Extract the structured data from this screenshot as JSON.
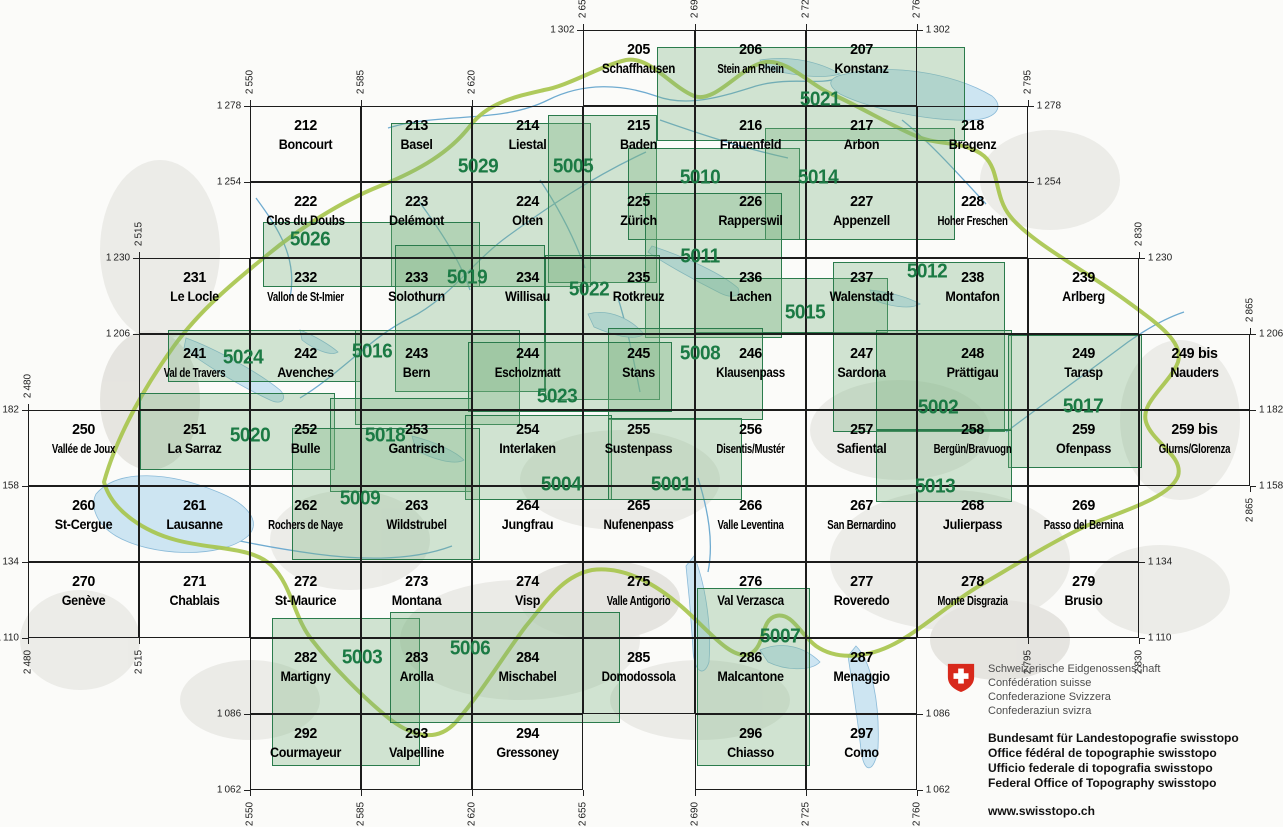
{
  "map": {
    "description": "Index of Swiss national map sheets with composite sheet numbers",
    "colors": {
      "grid_line": "#1c1c1c",
      "composite_fill": "rgba(122,178,128,0.33)",
      "composite_border": "#2a7b4c",
      "composite_label": "#1b7a44",
      "country_border": "#a6c44a",
      "lake": "#cde5f2",
      "river": "#6fabd0",
      "swiss_red": "#d8291c"
    },
    "sheets": [
      {
        "number": "205",
        "name": "Schaffhausen",
        "x_km": 2655,
        "y_km": 1302
      },
      {
        "number": "206",
        "name": "Stein am Rhein",
        "x_km": 2690,
        "y_km": 1302
      },
      {
        "number": "207",
        "name": "Konstanz",
        "x_km": 2725,
        "y_km": 1302
      },
      {
        "number": "212",
        "name": "Boncourt",
        "x_km": 2550,
        "y_km": 1278
      },
      {
        "number": "213",
        "name": "Basel",
        "x_km": 2585,
        "y_km": 1278
      },
      {
        "number": "214",
        "name": "Liestal",
        "x_km": 2620,
        "y_km": 1278
      },
      {
        "number": "215",
        "name": "Baden",
        "x_km": 2655,
        "y_km": 1278
      },
      {
        "number": "216",
        "name": "Frauenfeld",
        "x_km": 2690,
        "y_km": 1278
      },
      {
        "number": "217",
        "name": "Arbon",
        "x_km": 2725,
        "y_km": 1278
      },
      {
        "number": "218",
        "name": "Bregenz",
        "x_km": 2760,
        "y_km": 1278
      },
      {
        "number": "222",
        "name": "Clos du Doubs",
        "x_km": 2550,
        "y_km": 1254
      },
      {
        "number": "223",
        "name": "Delémont",
        "x_km": 2585,
        "y_km": 1254
      },
      {
        "number": "224",
        "name": "Olten",
        "x_km": 2620,
        "y_km": 1254
      },
      {
        "number": "225",
        "name": "Zürich",
        "x_km": 2655,
        "y_km": 1254
      },
      {
        "number": "226",
        "name": "Rapperswil",
        "x_km": 2690,
        "y_km": 1254
      },
      {
        "number": "227",
        "name": "Appenzell",
        "x_km": 2725,
        "y_km": 1254
      },
      {
        "number": "228",
        "name": "Hoher Freschen",
        "x_km": 2760,
        "y_km": 1254
      },
      {
        "number": "231",
        "name": "Le Locle",
        "x_km": 2515,
        "y_km": 1230
      },
      {
        "number": "232",
        "name": "Vallon de St-Imier",
        "x_km": 2550,
        "y_km": 1230
      },
      {
        "number": "233",
        "name": "Solothurn",
        "x_km": 2585,
        "y_km": 1230
      },
      {
        "number": "234",
        "name": "Willisau",
        "x_km": 2620,
        "y_km": 1230
      },
      {
        "number": "235",
        "name": "Rotkreuz",
        "x_km": 2655,
        "y_km": 1230
      },
      {
        "number": "236",
        "name": "Lachen",
        "x_km": 2690,
        "y_km": 1230
      },
      {
        "number": "237",
        "name": "Walenstadt",
        "x_km": 2725,
        "y_km": 1230
      },
      {
        "number": "238",
        "name": "Montafon",
        "x_km": 2760,
        "y_km": 1230
      },
      {
        "number": "239",
        "name": "Arlberg",
        "x_km": 2795,
        "y_km": 1230
      },
      {
        "number": "241",
        "name": "Val de Travers",
        "x_km": 2515,
        "y_km": 1206
      },
      {
        "number": "242",
        "name": "Avenches",
        "x_km": 2550,
        "y_km": 1206
      },
      {
        "number": "243",
        "name": "Bern",
        "x_km": 2585,
        "y_km": 1206
      },
      {
        "number": "244",
        "name": "Escholzmatt",
        "x_km": 2620,
        "y_km": 1206
      },
      {
        "number": "245",
        "name": "Stans",
        "x_km": 2655,
        "y_km": 1206
      },
      {
        "number": "246",
        "name": "Klausenpass",
        "x_km": 2690,
        "y_km": 1206
      },
      {
        "number": "247",
        "name": "Sardona",
        "x_km": 2725,
        "y_km": 1206
      },
      {
        "number": "248",
        "name": "Prättigau",
        "x_km": 2760,
        "y_km": 1206
      },
      {
        "number": "249",
        "name": "Tarasp",
        "x_km": 2795,
        "y_km": 1206
      },
      {
        "number": "249 bis",
        "name": "Nauders",
        "x_km": 2830,
        "y_km": 1206
      },
      {
        "number": "250",
        "name": "Vallée de Joux",
        "x_km": 2480,
        "y_km": 1182
      },
      {
        "number": "251",
        "name": "La Sarraz",
        "x_km": 2515,
        "y_km": 1182
      },
      {
        "number": "252",
        "name": "Bulle",
        "x_km": 2550,
        "y_km": 1182
      },
      {
        "number": "253",
        "name": "Gantrisch",
        "x_km": 2585,
        "y_km": 1182
      },
      {
        "number": "254",
        "name": "Interlaken",
        "x_km": 2620,
        "y_km": 1182
      },
      {
        "number": "255",
        "name": "Sustenpass",
        "x_km": 2655,
        "y_km": 1182
      },
      {
        "number": "256",
        "name": "Disentis/Mustér",
        "x_km": 2690,
        "y_km": 1182
      },
      {
        "number": "257",
        "name": "Safiental",
        "x_km": 2725,
        "y_km": 1182
      },
      {
        "number": "258",
        "name": "Bergün/Bravuogn",
        "x_km": 2760,
        "y_km": 1182
      },
      {
        "number": "259",
        "name": "Ofenpass",
        "x_km": 2795,
        "y_km": 1182
      },
      {
        "number": "259 bis",
        "name": "Glurns/Glorenza",
        "x_km": 2830,
        "y_km": 1182
      },
      {
        "number": "260",
        "name": "St-Cergue",
        "x_km": 2480,
        "y_km": 1158
      },
      {
        "number": "261",
        "name": "Lausanne",
        "x_km": 2515,
        "y_km": 1158
      },
      {
        "number": "262",
        "name": "Rochers de Naye",
        "x_km": 2550,
        "y_km": 1158
      },
      {
        "number": "263",
        "name": "Wildstrubel",
        "x_km": 2585,
        "y_km": 1158
      },
      {
        "number": "264",
        "name": "Jungfrau",
        "x_km": 2620,
        "y_km": 1158
      },
      {
        "number": "265",
        "name": "Nufenenpass",
        "x_km": 2655,
        "y_km": 1158
      },
      {
        "number": "266",
        "name": "Valle Leventina",
        "x_km": 2690,
        "y_km": 1158
      },
      {
        "number": "267",
        "name": "San Bernardino",
        "x_km": 2725,
        "y_km": 1158
      },
      {
        "number": "268",
        "name": "Julierpass",
        "x_km": 2760,
        "y_km": 1158
      },
      {
        "number": "269",
        "name": "Passo del Bernina",
        "x_km": 2795,
        "y_km": 1158
      },
      {
        "number": "270",
        "name": "Genève",
        "x_km": 2480,
        "y_km": 1134
      },
      {
        "number": "271",
        "name": "Chablais",
        "x_km": 2515,
        "y_km": 1134
      },
      {
        "number": "272",
        "name": "St-Maurice",
        "x_km": 2550,
        "y_km": 1134
      },
      {
        "number": "273",
        "name": "Montana",
        "x_km": 2585,
        "y_km": 1134
      },
      {
        "number": "274",
        "name": "Visp",
        "x_km": 2620,
        "y_km": 1134
      },
      {
        "number": "275",
        "name": "Valle Antigorio",
        "x_km": 2655,
        "y_km": 1134
      },
      {
        "number": "276",
        "name": "Val Verzasca",
        "x_km": 2690,
        "y_km": 1134
      },
      {
        "number": "277",
        "name": "Roveredo",
        "x_km": 2725,
        "y_km": 1134
      },
      {
        "number": "278",
        "name": "Monte Disgrazia",
        "x_km": 2760,
        "y_km": 1134
      },
      {
        "number": "279",
        "name": "Brusio",
        "x_km": 2795,
        "y_km": 1134
      },
      {
        "number": "282",
        "name": "Martigny",
        "x_km": 2550,
        "y_km": 1110
      },
      {
        "number": "283",
        "name": "Arolla",
        "x_km": 2585,
        "y_km": 1110
      },
      {
        "number": "284",
        "name": "Mischabel",
        "x_km": 2620,
        "y_km": 1110
      },
      {
        "number": "285",
        "name": "Domodossola",
        "x_km": 2655,
        "y_km": 1110
      },
      {
        "number": "286",
        "name": "Malcantone",
        "x_km": 2690,
        "y_km": 1110
      },
      {
        "number": "287",
        "name": "Menaggio",
        "x_km": 2725,
        "y_km": 1110
      },
      {
        "number": "292",
        "name": "Courmayeur",
        "x_km": 2550,
        "y_km": 1086
      },
      {
        "number": "293",
        "name": "Valpelline",
        "x_km": 2585,
        "y_km": 1086
      },
      {
        "number": "294",
        "name": "Gressoney",
        "x_km": 2620,
        "y_km": 1086
      },
      {
        "number": "296",
        "name": "Chiasso",
        "x_km": 2690,
        "y_km": 1086
      },
      {
        "number": "297",
        "name": "Como",
        "x_km": 2725,
        "y_km": 1086
      }
    ],
    "composites": [
      {
        "code": "5029",
        "rect": [
          391,
          123,
          200,
          164
        ],
        "label": [
          478,
          167
        ]
      },
      {
        "code": "5005",
        "rect": [
          548,
          115,
          109,
          168
        ],
        "label": [
          573,
          167
        ]
      },
      {
        "code": "5010",
        "rect": [
          628,
          148,
          172,
          92
        ],
        "label": [
          700,
          178
        ]
      },
      {
        "code": "5014",
        "rect": [
          765,
          128,
          190,
          112
        ],
        "label": [
          818,
          178
        ]
      },
      {
        "code": "5021",
        "rect": [
          657,
          47,
          308,
          94
        ],
        "label": [
          820,
          100
        ]
      },
      {
        "code": "5026",
        "rect": [
          263,
          222,
          217,
          65
        ],
        "label": [
          310,
          240
        ]
      },
      {
        "code": "5011",
        "rect": [
          645,
          193,
          137,
          145
        ],
        "label": [
          700,
          257
        ]
      },
      {
        "code": "5019",
        "rect": [
          395,
          245,
          150,
          147
        ],
        "label": [
          467,
          278
        ]
      },
      {
        "code": "5022",
        "rect": [
          545,
          255,
          115,
          145
        ],
        "label": [
          589,
          290
        ]
      },
      {
        "code": "5015",
        "rect": [
          695,
          278,
          193,
          55
        ],
        "label": [
          805,
          313
        ]
      },
      {
        "code": "5012",
        "rect": [
          833,
          262,
          172,
          170
        ],
        "label": [
          927,
          272
        ]
      },
      {
        "code": "5024",
        "rect": [
          168,
          330,
          194,
          52
        ],
        "label": [
          243,
          358
        ]
      },
      {
        "code": "5016",
        "rect": [
          355,
          330,
          165,
          95
        ],
        "label": [
          372,
          352
        ]
      },
      {
        "code": "5008",
        "rect": [
          608,
          328,
          155,
          92
        ],
        "label": [
          700,
          354
        ]
      },
      {
        "code": "5023",
        "rect": [
          468,
          342,
          204,
          70
        ],
        "label": [
          557,
          397
        ]
      },
      {
        "code": "5002",
        "rect": [
          876,
          330,
          136,
          100
        ],
        "label": [
          938,
          408
        ]
      },
      {
        "code": "5017",
        "rect": [
          1008,
          335,
          134,
          133
        ],
        "label": [
          1083,
          407
        ]
      },
      {
        "code": "5020",
        "rect": [
          140,
          393,
          195,
          77
        ],
        "label": [
          250,
          436
        ]
      },
      {
        "code": "5018",
        "rect": [
          330,
          398,
          142,
          94
        ],
        "label": [
          385,
          436
        ]
      },
      {
        "code": "5004",
        "rect": [
          465,
          415,
          147,
          85
        ],
        "label": [
          561,
          485
        ]
      },
      {
        "code": "5001",
        "rect": [
          608,
          418,
          134,
          82
        ],
        "label": [
          671,
          485
        ]
      },
      {
        "code": "5013",
        "rect": [
          876,
          430,
          136,
          72
        ],
        "label": [
          935,
          487
        ]
      },
      {
        "code": "5009",
        "rect": [
          292,
          428,
          188,
          132
        ],
        "label": [
          360,
          499
        ]
      },
      {
        "code": "5003",
        "rect": [
          272,
          618,
          148,
          148
        ],
        "label": [
          362,
          658
        ]
      },
      {
        "code": "5006",
        "rect": [
          390,
          612,
          230,
          111
        ],
        "label": [
          470,
          649
        ]
      },
      {
        "code": "5007",
        "rect": [
          697,
          588,
          113,
          178
        ],
        "label": [
          780,
          637
        ]
      }
    ],
    "y_lines": [
      {
        "km": 1302,
        "left": 2655,
        "right": 2760
      },
      {
        "km": 1278,
        "left": 2550,
        "right": 2795
      },
      {
        "km": 1254,
        "left": 2550,
        "right": 2795
      },
      {
        "km": 1230,
        "left": 2515,
        "right": 2830
      },
      {
        "km": 1206,
        "left": 2515,
        "right": 2865
      },
      {
        "km": 1182,
        "left": 2480,
        "right": 2865
      },
      {
        "km": 1158,
        "left": 2480,
        "right": 2865
      },
      {
        "km": 1134,
        "left": 2480,
        "right": 2830
      },
      {
        "km": 1110,
        "left": 2480,
        "right": 2830
      },
      {
        "km": 1086,
        "left": 2550,
        "right": 2760
      },
      {
        "km": 1062,
        "left": 2550,
        "right": 2760
      }
    ],
    "x_lines": [
      {
        "km": 2480,
        "top": 1182,
        "bottom": 1110
      },
      {
        "km": 2515,
        "top": 1230,
        "bottom": 1110
      },
      {
        "km": 2550,
        "top": 1278,
        "bottom": 1062
      },
      {
        "km": 2585,
        "top": 1278,
        "bottom": 1062
      },
      {
        "km": 2620,
        "top": 1278,
        "bottom": 1062
      },
      {
        "km": 2655,
        "top": 1302,
        "bottom": 1062
      },
      {
        "km": 2690,
        "top": 1302,
        "bottom": 1062
      },
      {
        "km": 2725,
        "top": 1302,
        "bottom": 1062
      },
      {
        "km": 2760,
        "top": 1302,
        "bottom": 1062
      },
      {
        "km": 2795,
        "top": 1278,
        "bottom": 1110
      },
      {
        "km": 2830,
        "top": 1230,
        "bottom": 1110
      },
      {
        "km": 2865,
        "top": 1206,
        "bottom": 1158
      }
    ]
  },
  "logo": {
    "confederation": [
      "Schweizerische Eidgenossenschaft",
      "Confédération suisse",
      "Confederazione Svizzera",
      "Confederaziun svizra"
    ],
    "office": [
      "Bundesamt für Landestopografie swisstopo",
      "Office fédéral de topographie swisstopo",
      "Ufficio federale di topografia swisstopo",
      "Federal Office of Topography swisstopo"
    ],
    "website": "www.swisstopo.ch"
  }
}
